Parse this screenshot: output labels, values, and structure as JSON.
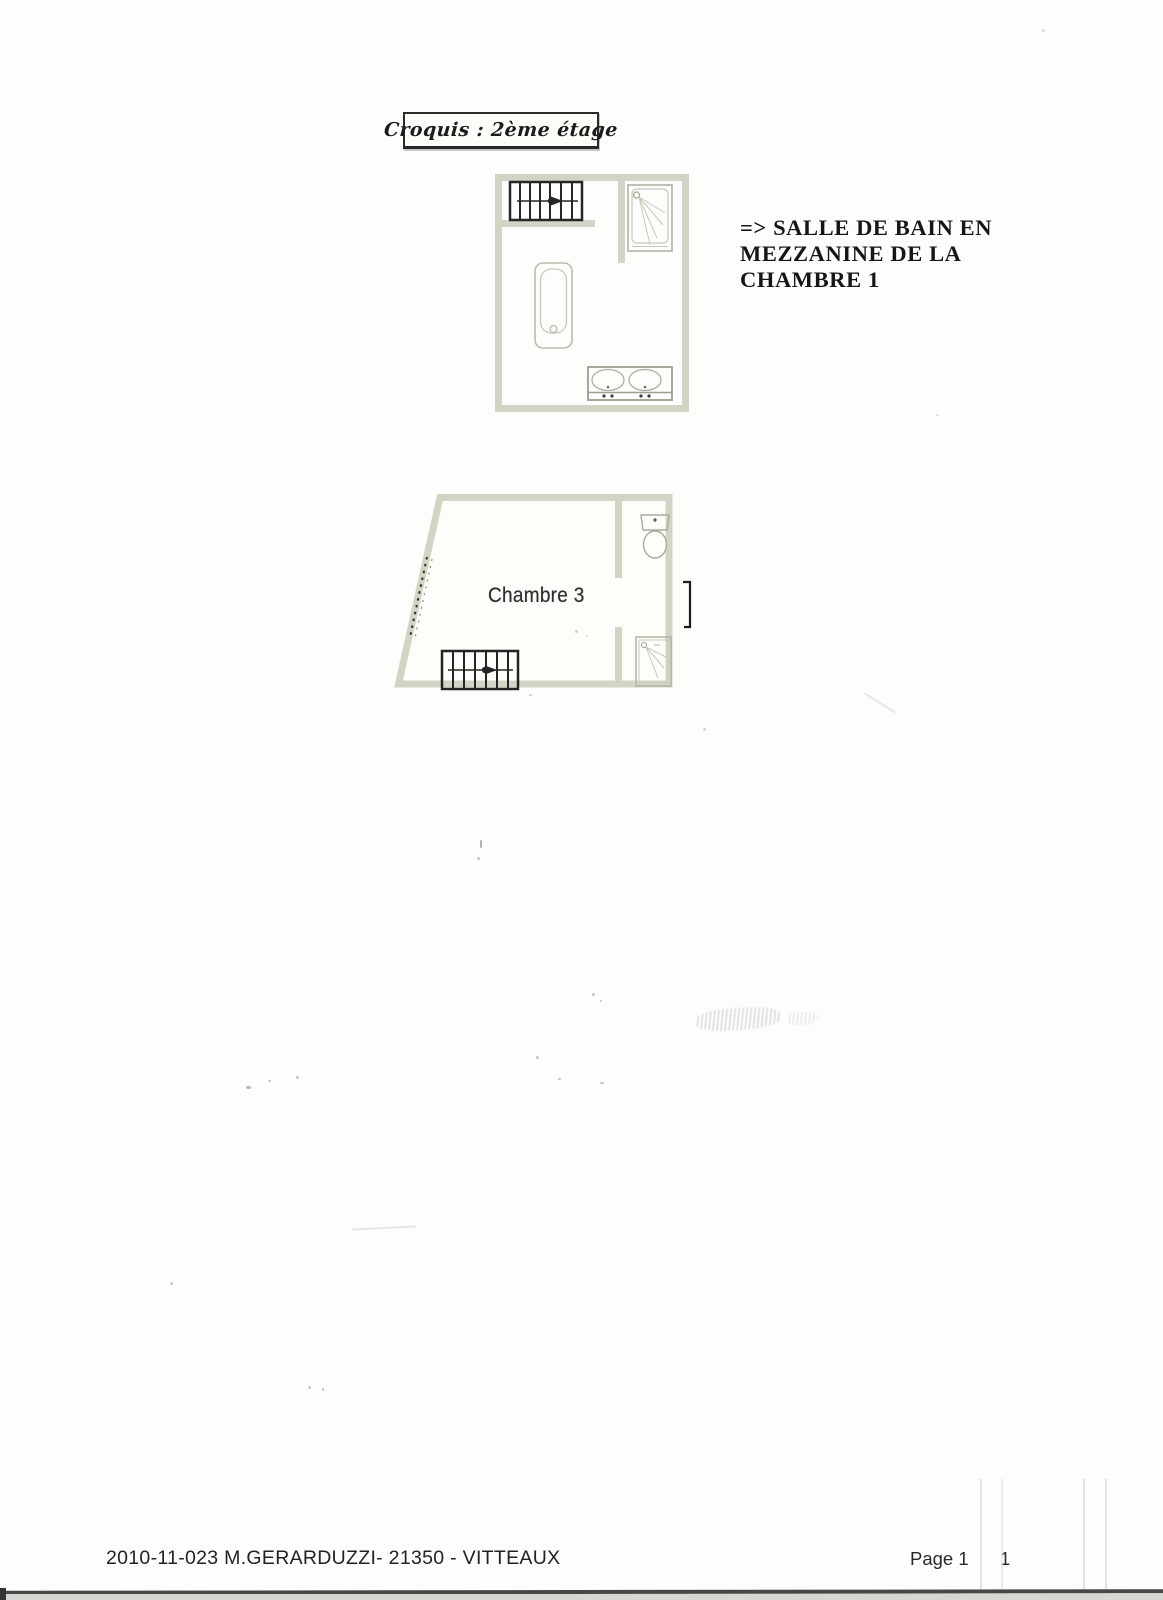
{
  "document": {
    "title": "Croquis :  2ème étage",
    "annotation_lines": [
      "=> SALLE DE BAIN EN",
      "MEZZANINE DE LA",
      "CHAMBRE 1"
    ],
    "room_label": "Chambre 3",
    "footer_reference": "2010-11-023 M.GERARDUZZI- 21350 - VITTEAUX",
    "footer_page_label": "Page 1",
    "footer_page_number": "1"
  },
  "plans": {
    "upper": {
      "name": "salle-de-bain-mezzanine",
      "fixtures": [
        "staircase",
        "shower",
        "bathtub",
        "double-sink"
      ]
    },
    "lower": {
      "name": "chambre-3",
      "fixtures": [
        "staircase",
        "toilet",
        "shower"
      ],
      "room_label": "Chambre 3"
    }
  },
  "colors": {
    "wall": "#d2d5c6",
    "fixture_line": "#b4b9a8",
    "fixture_line_light": "#c6cabb",
    "stairs_ink": "#262626",
    "text_ink": "#1c1c1c",
    "paper": "#fdfdfb"
  }
}
